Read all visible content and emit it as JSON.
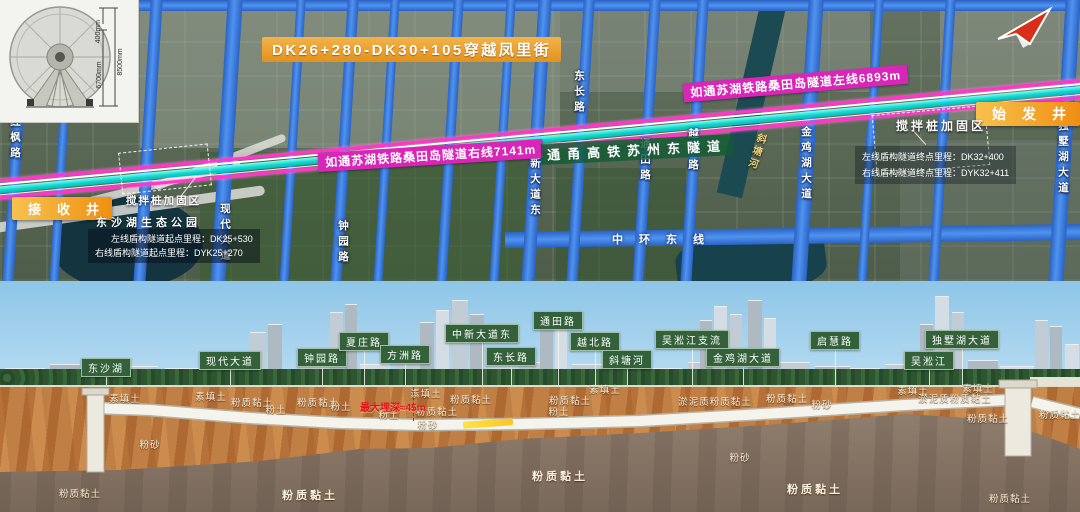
{
  "inset": {
    "dims": [
      "400mm",
      "6700mm",
      "8500mm"
    ]
  },
  "map": {
    "crossing_label": "DK26+280-DK30+105穿越凤里街",
    "left_line_label": "如通苏湖铁路桑田岛隧道左线6893m",
    "right_line_label": "如通苏湖铁路桑田岛隧道右线7141m",
    "parallel_label": "通甬高铁苏州东隧道",
    "launch_shaft": "始发井",
    "receiving_shaft": "接收井",
    "reinforcement_left": "搅拌桩加固区",
    "reinforcement_right": "搅拌桩加固区",
    "park_label": "东沙湖生态公园",
    "ring_road": "中环东线",
    "river_label": "斜塘河",
    "start_mileage": [
      "左线盾构隧道起点里程：DK25+530",
      "右线盾构隧道起点里程：DYK25+270"
    ],
    "end_mileage": [
      "左线盾构隧道终点里程：DK32+400",
      "右线盾构隧道终点里程：DYK32+411"
    ],
    "roads": [
      {
        "name": "红枫路",
        "x": 16,
        "w": 11,
        "label_y": 116
      },
      {
        "name": "",
        "x": 62,
        "w": 9,
        "label_y": 0
      },
      {
        "name": "",
        "x": 148,
        "w": 12,
        "label_y": 0
      },
      {
        "name": "现代大道",
        "x": 226,
        "w": 15,
        "label_y": 203
      },
      {
        "name": "",
        "x": 292,
        "w": 9,
        "label_y": 0
      },
      {
        "name": "钟园路",
        "x": 344,
        "w": 11,
        "label_y": 220
      },
      {
        "name": "",
        "x": 386,
        "w": 9,
        "label_y": 0
      },
      {
        "name": "",
        "x": 450,
        "w": 10,
        "label_y": 0
      },
      {
        "name": "",
        "x": 502,
        "w": 9,
        "label_y": 0
      },
      {
        "name": "中新大道东",
        "x": 536,
        "w": 13,
        "label_y": 142
      },
      {
        "name": "东长路",
        "x": 580,
        "w": 11,
        "label_y": 70
      },
      {
        "name": "通田路",
        "x": 646,
        "w": 11,
        "label_y": 138
      },
      {
        "name": "越北路",
        "x": 694,
        "w": 11,
        "label_y": 128
      },
      {
        "name": "金鸡湖大道",
        "x": 807,
        "w": 15,
        "label_y": 126
      },
      {
        "name": "",
        "x": 870,
        "w": 9,
        "label_y": 0
      },
      {
        "name": "",
        "x": 942,
        "w": 10,
        "label_y": 0
      },
      {
        "name": "独墅湖大道",
        "x": 1064,
        "w": 15,
        "label_y": 120
      }
    ]
  },
  "section": {
    "max_depth_label": "最大埋深≈45m",
    "landmarks": [
      {
        "label": "东沙湖",
        "x": 106,
        "y": 358
      },
      {
        "label": "现代大道",
        "x": 230,
        "y": 351
      },
      {
        "label": "钟园路",
        "x": 322,
        "y": 348
      },
      {
        "label": "夏庄路",
        "x": 364,
        "y": 332
      },
      {
        "label": "方洲路",
        "x": 405,
        "y": 345
      },
      {
        "label": "中新大道东",
        "x": 482,
        "y": 324
      },
      {
        "label": "东长路",
        "x": 511,
        "y": 347
      },
      {
        "label": "通田路",
        "x": 558,
        "y": 311
      },
      {
        "label": "越北路",
        "x": 595,
        "y": 332
      },
      {
        "label": "斜塘河",
        "x": 627,
        "y": 350
      },
      {
        "label": "吴淞江支流",
        "x": 692,
        "y": 330
      },
      {
        "label": "金鸡湖大道",
        "x": 743,
        "y": 348
      },
      {
        "label": "启慧路",
        "x": 835,
        "y": 331
      },
      {
        "label": "吴淞江",
        "x": 929,
        "y": 351
      },
      {
        "label": "独墅湖大道",
        "x": 962,
        "y": 330
      }
    ],
    "soils": [
      {
        "t": "素填土",
        "x": 125,
        "y": 391
      },
      {
        "t": "素填土",
        "x": 211,
        "y": 389
      },
      {
        "t": "粉质黏土",
        "x": 252,
        "y": 395
      },
      {
        "t": "粉土",
        "x": 276,
        "y": 402
      },
      {
        "t": "粉质黏土",
        "x": 318,
        "y": 395
      },
      {
        "t": "粉土",
        "x": 341,
        "y": 399
      },
      {
        "t": "素填土",
        "x": 426,
        "y": 386
      },
      {
        "t": "粉质黏土",
        "x": 471,
        "y": 392
      },
      {
        "t": "粉质黏土",
        "x": 437,
        "y": 404
      },
      {
        "t": "粉土",
        "x": 389,
        "y": 407
      },
      {
        "t": "粉砂",
        "x": 428,
        "y": 417
      },
      {
        "t": "粉质黏土",
        "x": 570,
        "y": 393
      },
      {
        "t": "粉土",
        "x": 559,
        "y": 404
      },
      {
        "t": "素填土",
        "x": 605,
        "y": 382
      },
      {
        "t": "淤泥质粉质黏土",
        "x": 715,
        "y": 394
      },
      {
        "t": "粉质黏土",
        "x": 787,
        "y": 391
      },
      {
        "t": "粉砂",
        "x": 822,
        "y": 397
      },
      {
        "t": "素填土",
        "x": 913,
        "y": 383
      },
      {
        "t": "素填土",
        "x": 978,
        "y": 381
      },
      {
        "t": "淤泥质粉质黏土",
        "x": 955,
        "y": 391
      },
      {
        "t": "粉质黏土",
        "x": 988,
        "y": 411
      },
      {
        "t": "粉质黏土",
        "x": 1060,
        "y": 407
      },
      {
        "t": "粉砂",
        "x": 150,
        "y": 437
      },
      {
        "t": "粉质黏土",
        "x": 310,
        "y": 487,
        "big": true
      },
      {
        "t": "粉质黏土",
        "x": 560,
        "y": 468,
        "big": true
      },
      {
        "t": "粉砂",
        "x": 740,
        "y": 450
      },
      {
        "t": "粉质黏土",
        "x": 815,
        "y": 481,
        "big": true
      },
      {
        "t": "粉质黏土",
        "x": 1010,
        "y": 491
      },
      {
        "t": "粉质黏土",
        "x": 80,
        "y": 486
      }
    ]
  }
}
